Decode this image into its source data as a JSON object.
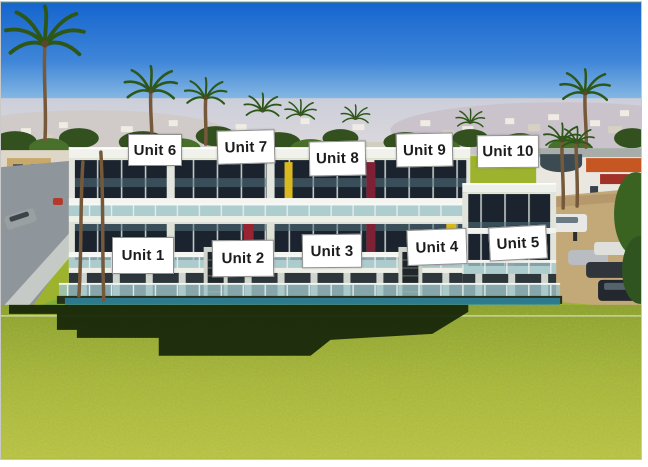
{
  "image": {
    "kind": "aerial-photo-with-unit-annotations",
    "building_floors_labeled": 2,
    "units_total": 10
  },
  "labels": [
    {
      "text": "Unit 1",
      "x": 112,
      "y": 237,
      "w": 62,
      "h": 37,
      "rot": 0
    },
    {
      "text": "Unit 2",
      "x": 212,
      "y": 240,
      "w": 62,
      "h": 37,
      "rot": -0.5
    },
    {
      "text": "Unit 3",
      "x": 302,
      "y": 234,
      "w": 60,
      "h": 34,
      "rot": -0.5
    },
    {
      "text": "Unit 4",
      "x": 407,
      "y": 229,
      "w": 60,
      "h": 36,
      "rot": -2
    },
    {
      "text": "Unit 5",
      "x": 489,
      "y": 226,
      "w": 58,
      "h": 34,
      "rot": -3
    },
    {
      "text": "Unit 6",
      "x": 128,
      "y": 134,
      "w": 54,
      "h": 32,
      "rot": 0
    },
    {
      "text": "Unit 7",
      "x": 217,
      "y": 130,
      "w": 58,
      "h": 34,
      "rot": -1.5
    },
    {
      "text": "Unit 8",
      "x": 309,
      "y": 141,
      "w": 57,
      "h": 35,
      "rot": -1
    },
    {
      "text": "Unit 9",
      "x": 396,
      "y": 133,
      "w": 57,
      "h": 34,
      "rot": -1
    },
    {
      "text": "Unit 10",
      "x": 477,
      "y": 135,
      "w": 62,
      "h": 33,
      "rot": -0.5
    }
  ],
  "colors": {
    "sky_top": "#1565cf",
    "sky_horizon": "#dce9ee",
    "lawn_green": "#a3b52f",
    "shadow_green": "#16260d",
    "building_white": "#e8ebe2",
    "window_dark": "#1b242e",
    "accent_red": "#8e2334",
    "accent_yellow": "#d9b91f",
    "glass_teal": "#a9cdd1",
    "parking_tan": "#c3a878",
    "street_grey": "#8f969b",
    "label_bg": "#ffffff",
    "label_border": "#8f8f8f",
    "label_text": "#1c1c1c"
  }
}
